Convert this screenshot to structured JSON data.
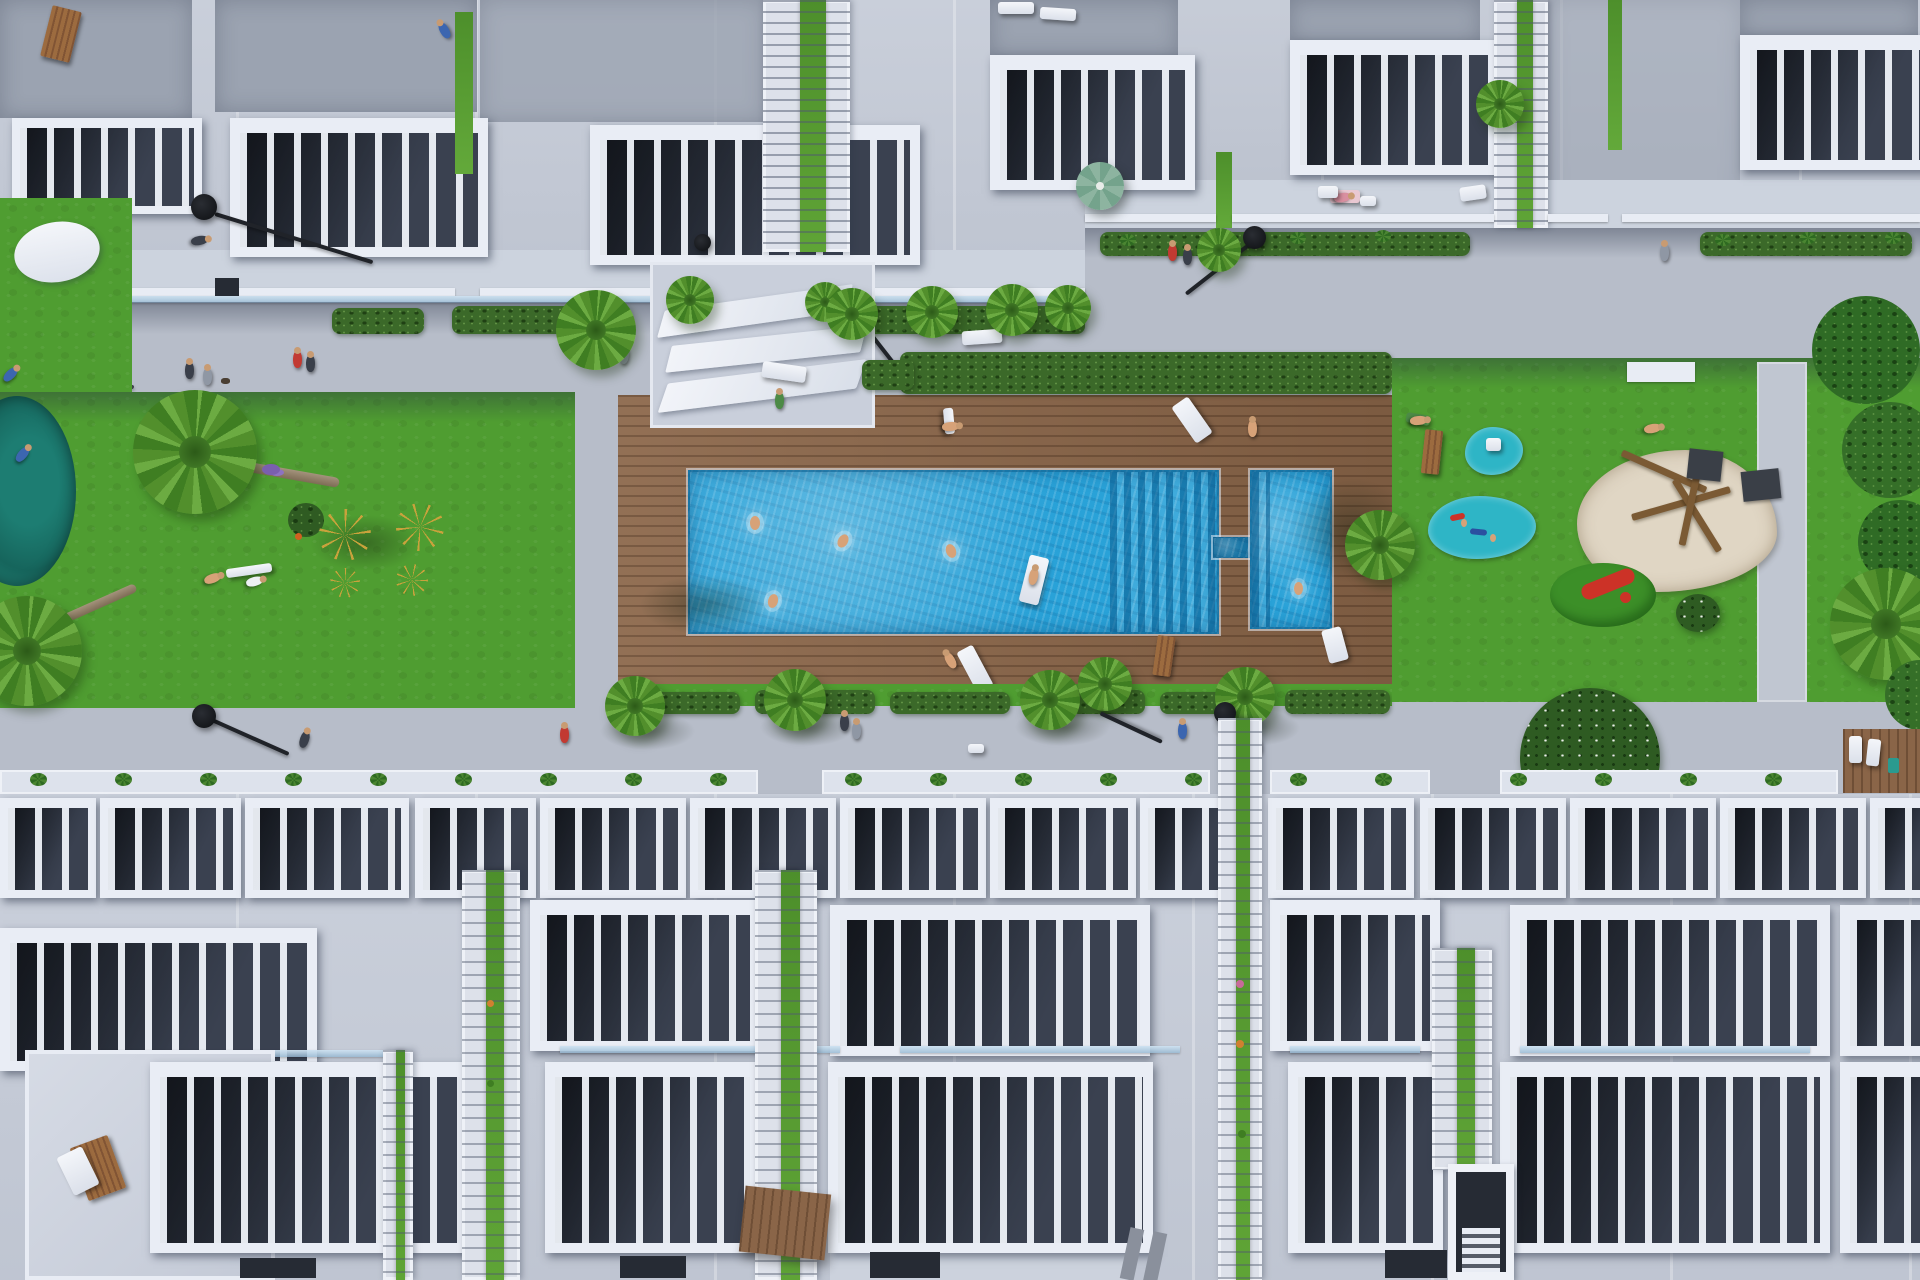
{
  "meta": {
    "domain": "Natural-Image",
    "description": "Top-down aerial 3D architectural rendering of a modern white townhouse complex with a central communal garden: wooden sun deck, rectangular swimming pool with submerged entry steps, kids pool, lawns, playgrounds, palm trees and pedestrian promenades.",
    "visible_text": "none"
  },
  "palette": {
    "walkway": "#b7bdc9",
    "walkway_light": "#c0c6d1",
    "building_light": "#c6ccd8",
    "building_light2": "#c3c9d5",
    "building_bottom": "#c8ceda",
    "roof_gray": "#9ba3b1",
    "white_structure": "#e9edf5",
    "pergola_interior": "#2b313e",
    "grass": "#4f9d31",
    "grass_mound": "#3c8f28",
    "hedge": "#3b6929",
    "deck_wood": "#8a6548",
    "pool_water": "#29a2d8",
    "pool_deep": "#1d83b4",
    "pond_teal": "#1d7d72",
    "splash_pad": "#2eb5c6",
    "sand": "#e0d6c4",
    "equipment_yellow": "#c9a23c",
    "umbrella_green": "#74a38c",
    "slide_red": "#cc3227",
    "lamp_black": "#17191d",
    "flower_purple": "#7a5fae"
  },
  "scene": {
    "top_building_row": {
      "pergola_terraces": 6,
      "stair_towers": 2,
      "green_roof_strips": 3,
      "roof_items": [
        "wooden deck chair",
        "two white sun loungers",
        "sunbather in blue",
        "sunbather on pink towel",
        "roof vent"
      ]
    },
    "upper_promenade": {
      "planter_hedges": 6,
      "palm_trees": 8,
      "street_lamps": 2,
      "green_parasol": 1,
      "white_terrace_furniture": 3,
      "pedestrians": 9
    },
    "west_garden": {
      "pond": 1,
      "leaning_palms": 2,
      "outdoor_gym_stations": 4,
      "shrubs": 2,
      "people_on_grass": 3
    },
    "pool_deck": {
      "material": "hardwood planks",
      "white_sculptural_benches": 3,
      "perimeter_hedge": true,
      "main_pool": {
        "shape": "rectangle",
        "entry": "submerged steps on east end",
        "swimmers": 4,
        "floats_with_person": 1
      },
      "kids_pool": {
        "shape": "rectangle",
        "swimmers": 1,
        "connected_by_channel": true
      },
      "sun_loungers": 5,
      "people_on_deck": 4
    },
    "east_playground": {
      "splash_pads": 2,
      "spring_riders": 2,
      "toy_box": 1,
      "sand_pit_with_climbing_frame": 1,
      "hill_with_red_slide": 1,
      "flowering_bushes": 2,
      "lawn_path": 1,
      "white_bench": 1,
      "sunbathers": 2
    },
    "lower_promenade": {
      "street_lamps": 2,
      "pedestrians": 6,
      "agave_planter_strip": true,
      "wooden_sun_deck_corner": 1
    },
    "bottom_building_rows": {
      "terrace_tiers": 3,
      "narrow_pergolas_tier1": 14,
      "wide_pergolas": 11,
      "stair_cores_with_planting": 5,
      "roof_items": [
        "wooden chair with white blanket",
        "pallet bench",
        "rooftop stair shaft",
        "dark skylight slots"
      ]
    }
  }
}
